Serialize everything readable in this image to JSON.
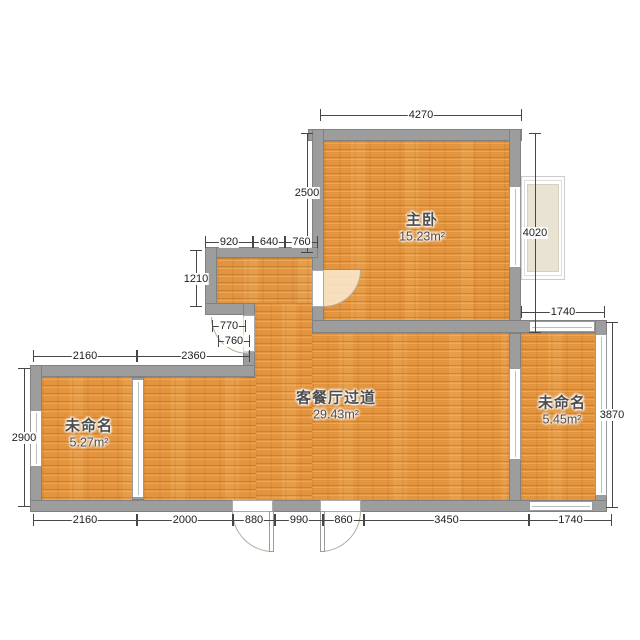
{
  "colors": {
    "floor_base": "#e2943f",
    "floor_stripe": "#c8802f",
    "wall_fill": "#9d9d9d",
    "wall_edge": "#818181",
    "dim_line": "#474747",
    "dim_text": "#1e1e1e",
    "label_text": "#4d4d4d",
    "bay_fill": "#e9e3d3",
    "background": "#ffffff"
  },
  "plan": {
    "rooms": [
      {
        "id": "master-bedroom",
        "name": "主卧",
        "area": "15.23m²",
        "cx": 422,
        "cy": 226
      },
      {
        "id": "living-dining-hall",
        "name": "客餐厅过道",
        "area": "29.43m²",
        "cx": 336,
        "cy": 404
      },
      {
        "id": "unnamed-left",
        "name": "未命名",
        "area": "5.27m²",
        "cx": 89,
        "cy": 432
      },
      {
        "id": "unnamed-right",
        "name": "未命名",
        "area": "5.45m²",
        "cx": 562,
        "cy": 409
      }
    ],
    "floors": [
      {
        "id": "master-bedroom",
        "x": 324,
        "y": 141,
        "w": 186,
        "h": 180
      },
      {
        "id": "niche",
        "x": 217,
        "y": 258,
        "w": 96,
        "h": 46
      },
      {
        "id": "corridor",
        "x": 255,
        "y": 303,
        "w": 58,
        "h": 198
      },
      {
        "id": "living-right",
        "x": 312,
        "y": 333,
        "w": 198,
        "h": 168
      },
      {
        "id": "living-left",
        "x": 144,
        "y": 377,
        "w": 112,
        "h": 124
      },
      {
        "id": "room-left",
        "x": 42,
        "y": 377,
        "w": 91,
        "h": 124
      },
      {
        "id": "room-right",
        "x": 521,
        "y": 333,
        "w": 75,
        "h": 168
      }
    ],
    "walls": [
      {
        "id": "mb-top",
        "x": 308,
        "y": 129,
        "w": 214,
        "h": 12
      },
      {
        "id": "mb-left",
        "x": 312,
        "y": 129,
        "w": 12,
        "h": 203
      },
      {
        "id": "mb-right",
        "x": 509,
        "y": 129,
        "w": 12,
        "h": 204
      },
      {
        "id": "mid-band",
        "x": 312,
        "y": 320,
        "w": 295,
        "h": 13
      },
      {
        "id": "niche-top",
        "x": 205,
        "y": 247,
        "w": 113,
        "h": 11
      },
      {
        "id": "niche-left",
        "x": 205,
        "y": 247,
        "w": 12,
        "h": 68
      },
      {
        "id": "niche-corner",
        "x": 205,
        "y": 303,
        "w": 50,
        "h": 12
      },
      {
        "id": "niche-vertical",
        "x": 243,
        "y": 303,
        "w": 12,
        "h": 75
      },
      {
        "id": "left-top",
        "x": 30,
        "y": 365,
        "w": 225,
        "h": 12
      },
      {
        "id": "left-outer",
        "x": 30,
        "y": 365,
        "w": 12,
        "h": 147
      },
      {
        "id": "left-partition",
        "x": 132,
        "y": 377,
        "w": 12,
        "h": 123
      },
      {
        "id": "center-right",
        "x": 509,
        "y": 333,
        "w": 12,
        "h": 179
      },
      {
        "id": "right-room-right",
        "x": 595,
        "y": 320,
        "w": 12,
        "h": 192
      },
      {
        "id": "bottom-band",
        "x": 30,
        "y": 500,
        "w": 577,
        "h": 12
      }
    ],
    "windows": [
      {
        "id": "master-bedroom-east",
        "o": "v",
        "x": 509,
        "y": 186,
        "w": 12,
        "h": 82
      },
      {
        "id": "left-room-west",
        "o": "v",
        "x": 30,
        "y": 410,
        "w": 12,
        "h": 57
      },
      {
        "id": "slider-living-to-right-room",
        "o": "v",
        "x": 509,
        "y": 368,
        "w": 12,
        "h": 92
      },
      {
        "id": "right-room-east",
        "o": "v",
        "x": 595,
        "y": 334,
        "w": 12,
        "h": 162
      },
      {
        "id": "right-room-north",
        "o": "h",
        "x": 529,
        "y": 321,
        "w": 66,
        "h": 11
      },
      {
        "id": "right-room-south",
        "o": "h",
        "x": 529,
        "y": 501,
        "w": 64,
        "h": 10
      },
      {
        "id": "slider-living-to-left-room",
        "o": "v",
        "x": 132,
        "y": 379,
        "w": 12,
        "h": 119
      }
    ],
    "openings": [
      {
        "id": "master-bedroom-door",
        "x": 312,
        "y": 270,
        "w": 12,
        "h": 37
      },
      {
        "id": "niche-door",
        "x": 243,
        "y": 315,
        "w": 12,
        "h": 37
      },
      {
        "id": "entry-door-left",
        "x": 232,
        "y": 500,
        "w": 41,
        "h": 12
      },
      {
        "id": "entry-door-right",
        "x": 320,
        "y": 500,
        "w": 41,
        "h": 12
      }
    ],
    "arcs": [
      {
        "id": "master-bedroom-door",
        "x": 324,
        "y": 270,
        "w": 37,
        "h": 37,
        "corner": "br",
        "fill": "fillbeige"
      },
      {
        "id": "niche-door",
        "x": 211,
        "y": 317,
        "w": 37,
        "h": 37,
        "corner": "bl",
        "fill": "fillfaint"
      },
      {
        "id": "entry-door-left",
        "x": 232,
        "y": 511,
        "w": 41,
        "h": 41,
        "corner": "bl",
        "fill": ""
      },
      {
        "id": "entry-door-right",
        "x": 320,
        "y": 511,
        "w": 41,
        "h": 41,
        "corner": "br",
        "fill": ""
      }
    ],
    "leaves": [
      {
        "id": "entry-door-left-leaf",
        "x": 269,
        "y": 511,
        "w": 5,
        "h": 41
      },
      {
        "id": "entry-door-right-leaf",
        "x": 320,
        "y": 511,
        "w": 5,
        "h": 41
      }
    ],
    "bay": {
      "outer": {
        "x": 521,
        "y": 176,
        "w": 44,
        "h": 104
      },
      "mid": {
        "x": 524,
        "y": 180,
        "w": 38,
        "h": 96
      },
      "inner": {
        "x": 527,
        "y": 184,
        "w": 32,
        "h": 88
      }
    },
    "dims": [
      {
        "o": "h",
        "x": 320,
        "y": 115,
        "len": 202,
        "label": "4270"
      },
      {
        "o": "v",
        "x": 307,
        "y": 133,
        "len": 120,
        "label": "2500"
      },
      {
        "o": "v",
        "x": 535,
        "y": 133,
        "len": 200,
        "label": "4020"
      },
      {
        "o": "h",
        "x": 205,
        "y": 242,
        "len": 48,
        "label": "920"
      },
      {
        "o": "h",
        "x": 253,
        "y": 242,
        "len": 32,
        "label": "640"
      },
      {
        "o": "h",
        "x": 285,
        "y": 242,
        "len": 33,
        "label": "760"
      },
      {
        "o": "v",
        "x": 196,
        "y": 250,
        "len": 57,
        "label": "1210"
      },
      {
        "o": "h",
        "x": 212,
        "y": 326,
        "len": 34,
        "label": "770"
      },
      {
        "o": "h",
        "x": 218,
        "y": 341,
        "len": 32,
        "label": "760"
      },
      {
        "o": "h",
        "x": 33,
        "y": 356,
        "len": 104,
        "label": "2160"
      },
      {
        "o": "h",
        "x": 137,
        "y": 356,
        "len": 113,
        "label": "2360"
      },
      {
        "o": "v",
        "x": 24,
        "y": 368,
        "len": 139,
        "label": "2900"
      },
      {
        "o": "h",
        "x": 521,
        "y": 312,
        "len": 84,
        "label": "1740"
      },
      {
        "o": "v",
        "x": 612,
        "y": 322,
        "len": 186,
        "label": "3870"
      },
      {
        "o": "h",
        "x": 33,
        "y": 520,
        "len": 104,
        "label": "2160"
      },
      {
        "o": "h",
        "x": 137,
        "y": 520,
        "len": 96,
        "label": "2000"
      },
      {
        "o": "h",
        "x": 233,
        "y": 520,
        "len": 42,
        "label": "880"
      },
      {
        "o": "h",
        "x": 275,
        "y": 520,
        "len": 48,
        "label": "990"
      },
      {
        "o": "h",
        "x": 323,
        "y": 520,
        "len": 41,
        "label": "860"
      },
      {
        "o": "h",
        "x": 364,
        "y": 520,
        "len": 165,
        "label": "3450"
      },
      {
        "o": "h",
        "x": 529,
        "y": 520,
        "len": 83,
        "label": "1740"
      }
    ]
  }
}
